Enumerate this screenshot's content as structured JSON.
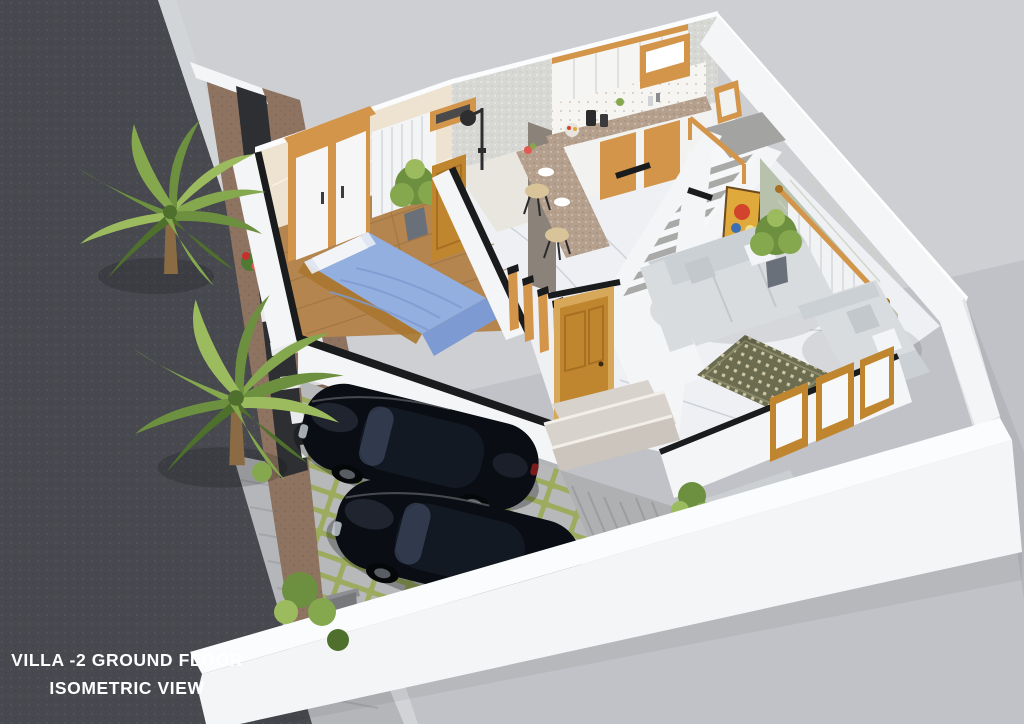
{
  "caption": {
    "line1": "VILLA -2 GROUND FLOOR",
    "line2": "ISOMETRIC VIEW"
  },
  "scene": {
    "type": "3d-isometric-ground-floor-render",
    "rooms": [
      "bedroom",
      "bathroom",
      "kitchen",
      "breakfast-bar",
      "staircase",
      "living-room",
      "foyer",
      "car-porch",
      "garden"
    ],
    "objects": [
      "asphalt-road",
      "paved-sidewalk",
      "compound-wall",
      "gate-pillar",
      "palm-tree",
      "palm-tree",
      "flower-bed",
      "stepping-stones",
      "dark-planter-wall",
      "wardrobe",
      "double-bed-blue",
      "window-curtain",
      "potted-plant",
      "bedroom-door",
      "shower-set",
      "vent-window",
      "upper-cabinets",
      "granite-counter",
      "base-cabinets",
      "breakfast-bar",
      "bar-stools",
      "u-shaped-staircase",
      "wood-railing",
      "wall-artwork",
      "sofa-three-seater",
      "sofa-two-seater",
      "patterned-area-rug",
      "green-accent-wall",
      "sheer-curtains",
      "wooden-windows",
      "main-entrance-door",
      "slat-partition",
      "entrance-steps",
      "black-sports-car",
      "black-sports-car",
      "garden-shrub"
    ]
  },
  "colors": {
    "bg1": "#cdcfd3",
    "bg2": "#b6b8be",
    "road": "#47494f",
    "roadSpeck": "#5d5f66",
    "roadSpeck2": "#3a3c42",
    "curb": "#d3d5d8",
    "walk": "#b4b6ba",
    "walkLine": "#a0a2a6",
    "soil": "#8d7360",
    "soilDot": "#a58a74",
    "planter": "#2d2f33",
    "stone": "#e9eaec",
    "leaf1": "#6d9040",
    "leaf2": "#85a84e",
    "leaf3": "#9cbb5f",
    "leafDark": "#4e702c",
    "trunk": "#8a6b44",
    "flower": "#c5302f",
    "flower2": "#e25a52",
    "flowerGreen": "#4e7a33",
    "white": "#f4f5f7",
    "wallShade": "#e2e4e8",
    "wallTopWhite": "#fbfcfd",
    "blackTop": "#1a1b1d",
    "beige": "#eee2d0",
    "texGray": "#d7d8d4",
    "texDot": "#c6c7c3",
    "greenWall": "#b7c1ac",
    "curtain": "#f3f4f6",
    "curtainFold": "#dcdee2",
    "marble": "#eef0f3",
    "vein": "#c8cdd3",
    "wood": "#b5854f",
    "plank": "#9c7140",
    "cabWood": "#d2954a",
    "doorWood": "#c0862f",
    "doorWood2": "#a76f22",
    "granite": "#b5a08e",
    "graniteDot": "#8f7a66",
    "bedBlue": "#93afdf",
    "bedBlueDk": "#7d9bd2",
    "pillow": "#f2f4f7",
    "sofa": "#d9dcdf",
    "sofaDk": "#cbd0d4",
    "rug": "#6c6c50",
    "rugDot": "#d8d2b0",
    "art": "#e0a93c",
    "carBody": "#0a0d13",
    "carHi": "#333c4b",
    "cabin": "#131923",
    "glassHi": "#48566f",
    "rim": "#585d64",
    "paver": "#b6b8ba",
    "grass": "#9cab5e",
    "concrete": "#aeb0b2",
    "concLine": "#9b9ea1",
    "tread": "#a9a9a7",
    "landing": "#a3a3a1",
    "stool": "#d9c49a",
    "marbleStep": "#d7d2cb",
    "marbleStep2": "#cbc5bd",
    "shower": "#2e2e30",
    "bath": "#e9e6df",
    "slabDoor": "#8b8279",
    "pillar": "#76787c",
    "gate": "#43454a",
    "pot": "#6a7079",
    "caption": "#ffffff"
  }
}
